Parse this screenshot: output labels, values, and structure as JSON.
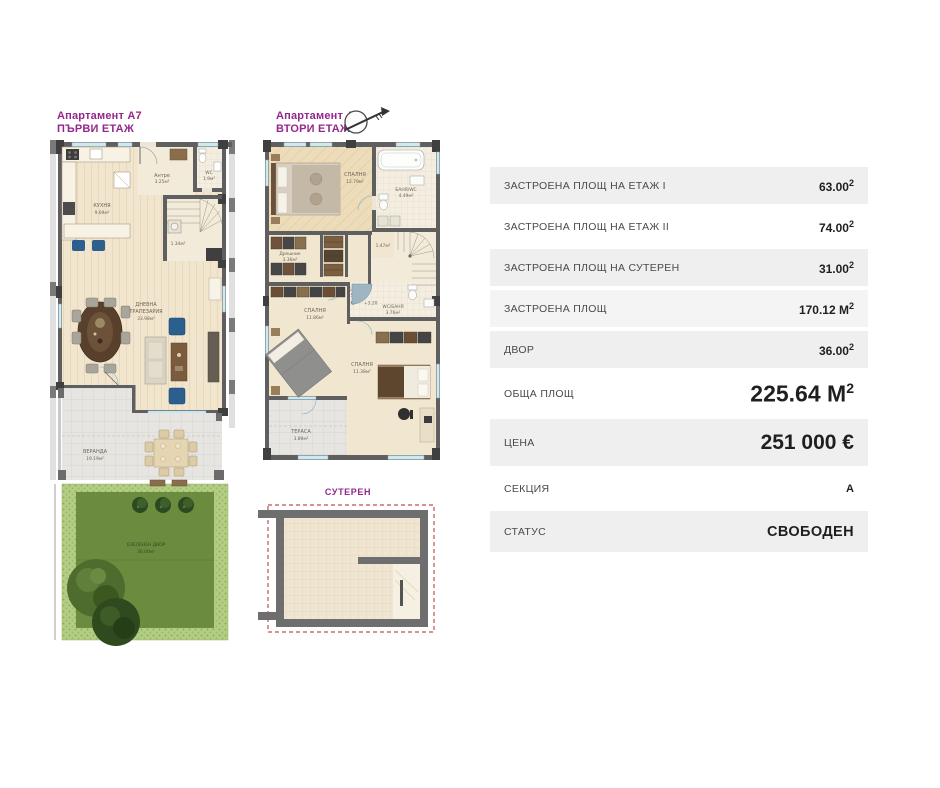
{
  "plans": {
    "first_floor": {
      "title_line1": "Апартамент А7",
      "title_line2": "ПЪРВИ ЕТАЖ",
      "rooms": {
        "kitchen_name": "КУХНЯ",
        "kitchen_area": "9.69м²",
        "entry_name": "Антре",
        "entry_area": "3.25м²",
        "wc_name": "WC",
        "wc_area": "1.9м²",
        "stair_area": "1.34м²",
        "living_name1": "ДНЕВНА",
        "living_name2": "ТРАПЕЗАРИЯ",
        "living_area": "33.98м²",
        "veranda_name": "ВЕРАНДА",
        "veranda_area": "19.19м²",
        "garden_name": "ОЗЕЛЕНЕН ДВОР",
        "garden_area": "36.00м²"
      }
    },
    "second_floor": {
      "title_line1": "Апартамент А7",
      "title_line2": "ВТОРИ ЕТАЖ",
      "rooms": {
        "bedroom1_name": "СПАЛНЯ",
        "bedroom1_area": "12.79м²",
        "bath_name": "БАНЯ/WC",
        "bath_area": "4.49м²",
        "closet_name": "Дрешник",
        "closet_area": "3.36м²",
        "niche_area": "1.47м²",
        "corridor_name": "Коридор",
        "corridor_area": "5.36м²",
        "corridor_level": "+3.20",
        "bedroom2_name": "СПАЛНЯ",
        "bedroom2_area": "11.86м²",
        "wc2_name": "WC/БАНЯ",
        "wc2_area": "3.76м²",
        "bedroom3_name": "СПАЛНЯ",
        "bedroom3_area": "11.38м²",
        "terrace_name": "ТЕРАСА",
        "terrace_area": "3.89м²"
      }
    },
    "basement": {
      "title": "СУТЕРЕН"
    }
  },
  "table": {
    "rows": [
      {
        "label": "ЗАСТРОЕНА ПЛОЩ НА ЕТАЖ I",
        "value": "63.00",
        "sup": "2"
      },
      {
        "label": "ЗАСТРОЕНА ПЛОЩ НА ЕТАЖ II",
        "value": "74.00",
        "sup": "2"
      },
      {
        "label": "ЗАСТРОЕНА ПЛОЩ НА СУТЕРЕН",
        "value": "31.00",
        "sup": "2"
      },
      {
        "label": "ЗАСТРОЕНА ПЛОЩ",
        "value": "170.12 М",
        "sup": "2"
      },
      {
        "label": "ДВОР",
        "value": "36.00",
        "sup": "2"
      },
      {
        "label": "ОБЩА ПЛОЩ",
        "value": "225.64 М",
        "sup": "2"
      },
      {
        "label": "ЦЕНА",
        "value": "251 000 €"
      },
      {
        "label": "СЕКЦИЯ",
        "value": "А"
      },
      {
        "label": "СТАТУС",
        "value": "СВОБОДЕН"
      }
    ]
  },
  "colors": {
    "accent_purple": "#94278D",
    "row_gray": "#F0EFEF",
    "wall_gray": "#5F5F5F",
    "floor_cream": "#F1E6CF",
    "window_blue": "#CFE9F1",
    "furniture_blue": "#2D5F8E",
    "lawn_green": "#6B8C3E",
    "hedge_green": "#B3CD84",
    "dash_red": "#C05050"
  }
}
